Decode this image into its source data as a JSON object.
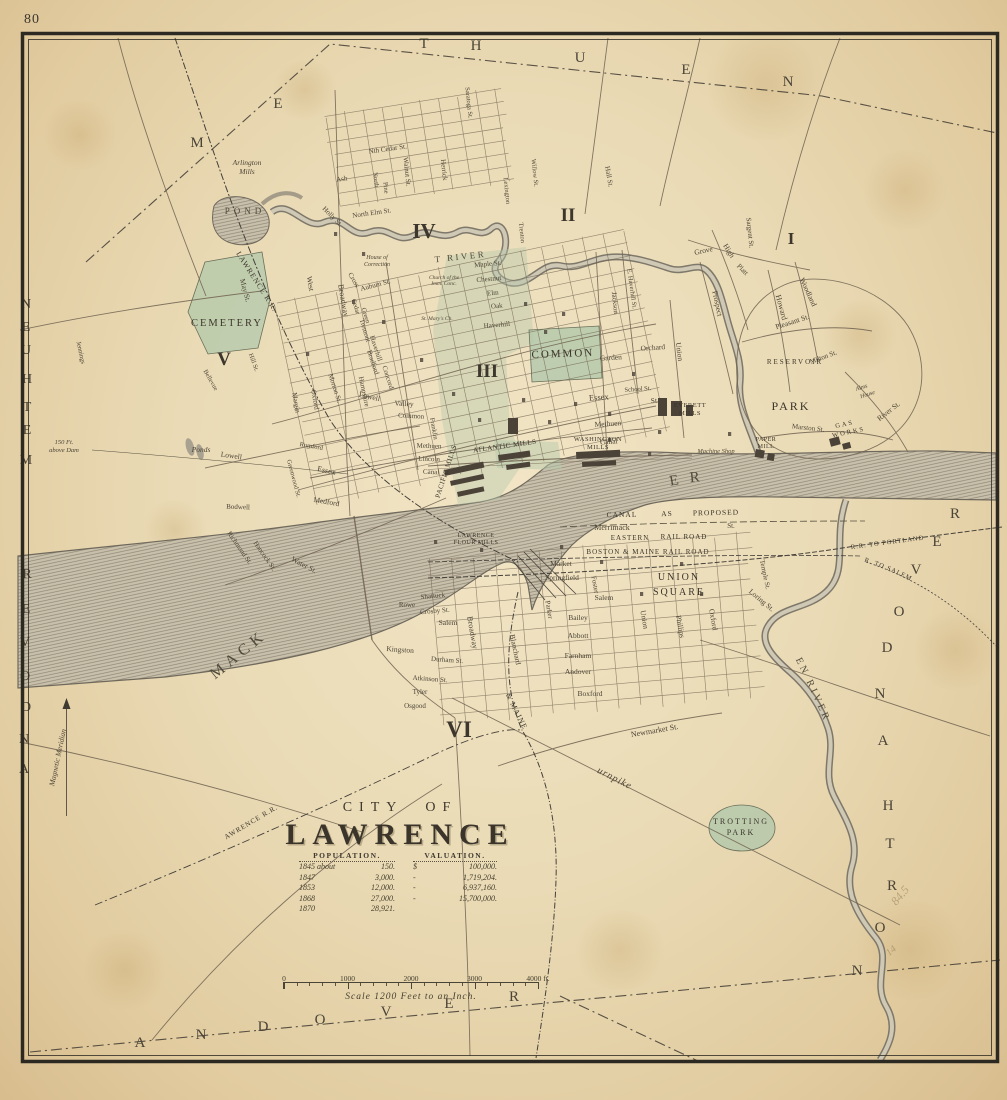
{
  "page_number": "80",
  "colors": {
    "paper": "#eadbb6",
    "ink": "#3e3830",
    "street": "#6f6250",
    "water_fill": "#c6bda8",
    "water_line": "#6f695c",
    "park_green": "#b4c8a9",
    "rail": "#45403a",
    "border": "#2c2822"
  },
  "title_block": {
    "line1": "CITY OF",
    "line2": "LAWRENCE"
  },
  "statistics": {
    "population_header": "POPULATION.",
    "valuation_header": "VALUATION.",
    "population_rows": [
      [
        "1845 about",
        "150."
      ],
      [
        "1847",
        "3,000."
      ],
      [
        "1853",
        "12,000."
      ],
      [
        "1868",
        "27,000."
      ],
      [
        "1870",
        "28,921."
      ]
    ],
    "valuation_rows": [
      [
        "$",
        "100,000."
      ],
      [
        "-",
        "1,719,204."
      ],
      [
        "-",
        "6,937,160."
      ],
      [
        "-",
        "15,700,000."
      ]
    ]
  },
  "scale_bar": {
    "tick_labels": [
      "0",
      "1000",
      "2000",
      "3000",
      "4000 ft."
    ],
    "caption": "Scale 1200 Feet to an Inch."
  },
  "boundaries": {
    "north": "METHUEN",
    "west_upper": "METHUEN",
    "west_lower": "ANDOVER",
    "south": "ANDOVER",
    "east": "NORTH ANDOVER"
  },
  "districts": [
    "I",
    "II",
    "III",
    "IV",
    "V",
    "VI"
  ],
  "waterways": [
    "MERRIMACK RIVER",
    "SPICKET RIVER",
    "SHAWSHEEN RIVER",
    "POND",
    "Ponds"
  ],
  "railroads": [
    "MANCHESTER & LAWRENCE R.R.",
    "LOWELL AND LAWRENCE R.R.",
    "EASTERN RAIL ROAD",
    "BOSTON & MAINE RAIL ROAD",
    "BOSTON & MAINE R.R. TO PORTLAND",
    "EASTERN R.R. TO SALEM",
    "BOSTON & MAINE",
    "CANAL AS PROPOSED"
  ],
  "compass_label": "Magnetic Meridian",
  "elevation_note": "150 Ft. above Dam",
  "curved_labels": [
    {
      "t": "MERRIMACK",
      "path": "cpMerrimack",
      "s": 16,
      "ls": 5,
      "c": "w"
    },
    {
      "t": "RIVER",
      "path": "cpRiver",
      "s": 15,
      "ls": 11,
      "c": "w"
    },
    {
      "t": "SPICKET RIVER",
      "path": "cpSpicket",
      "s": 9,
      "ls": 2.5,
      "c": "w"
    },
    {
      "t": "SHAWSHEEN RIVER",
      "path": "cpShawsheen",
      "s": 10,
      "ls": 3,
      "c": "w"
    },
    {
      "t": "MANCHESTER & LAWRENCE R.R.",
      "path": "cpML",
      "s": 7.5,
      "ls": 1,
      "c": "rr"
    },
    {
      "t": "LOWELL AND LAWRENCE R.R.",
      "path": "cpLL",
      "s": 7,
      "ls": 0.5,
      "c": "rr"
    },
    {
      "t": "BOSTON & MAINE R.R. TO PORTLAND",
      "path": "cpPortland",
      "s": 6.5,
      "ls": 0.3,
      "c": "rr"
    },
    {
      "t": "EASTERN R.R. TO SALEM",
      "path": "cpSalem",
      "s": 6.5,
      "ls": 0.5,
      "c": "rr"
    },
    {
      "t": "BOSTON & MAINE",
      "path": "cpBMsouth",
      "s": 7.5,
      "ls": 1.5,
      "c": "rr"
    },
    {
      "t": "Salem Turnpike",
      "path": "cpTurnpike",
      "s": 10,
      "ls": 1,
      "c": "n"
    }
  ],
  "labels": [
    [
      "M",
      197,
      147,
      0,
      15,
      "e"
    ],
    [
      "E",
      278,
      108,
      0,
      15,
      "e"
    ],
    [
      "T",
      424,
      48,
      0,
      15,
      "e"
    ],
    [
      "H",
      476,
      50,
      0,
      15,
      "e"
    ],
    [
      "U",
      580,
      62,
      0,
      15,
      "e"
    ],
    [
      "E",
      686,
      74,
      0,
      15,
      "e"
    ],
    [
      "N",
      788,
      86,
      0,
      15,
      "e"
    ],
    [
      "N",
      26,
      308,
      0,
      14,
      "e"
    ],
    [
      "E",
      26,
      331,
      0,
      14,
      "e"
    ],
    [
      "U",
      26,
      354,
      0,
      14,
      "e"
    ],
    [
      "H",
      27,
      383,
      0,
      14,
      "e"
    ],
    [
      "T",
      27,
      411,
      0,
      14,
      "e"
    ],
    [
      "E",
      27,
      434,
      0,
      14,
      "e"
    ],
    [
      "M",
      26,
      464,
      0,
      14,
      "e"
    ],
    [
      "R",
      27,
      578,
      0,
      14,
      "e"
    ],
    [
      "E",
      26,
      613,
      0,
      14,
      "e"
    ],
    [
      "V",
      25,
      646,
      0,
      14,
      "e"
    ],
    [
      "O",
      25,
      680,
      0,
      14,
      "e"
    ],
    [
      "D",
      26,
      711,
      0,
      14,
      "e"
    ],
    [
      "N",
      24,
      743,
      0,
      14,
      "e"
    ],
    [
      "A",
      24,
      773,
      0,
      14,
      "e"
    ],
    [
      "A",
      140,
      1047,
      0,
      15,
      "e"
    ],
    [
      "N",
      201,
      1039,
      0,
      15,
      "e"
    ],
    [
      "D",
      263,
      1031,
      0,
      15,
      "e"
    ],
    [
      "O",
      320,
      1024,
      0,
      15,
      "e"
    ],
    [
      "V",
      386,
      1016,
      0,
      15,
      "e"
    ],
    [
      "E",
      449,
      1008,
      0,
      15,
      "e"
    ],
    [
      "R",
      514,
      1001,
      0,
      15,
      "e"
    ],
    [
      "R",
      955,
      518,
      0,
      15,
      "e"
    ],
    [
      "E",
      937,
      546,
      0,
      15,
      "e"
    ],
    [
      "V",
      916,
      574,
      0,
      15,
      "e"
    ],
    [
      "O",
      899,
      616,
      0,
      15,
      "e"
    ],
    [
      "D",
      887,
      652,
      0,
      15,
      "e"
    ],
    [
      "N",
      880,
      698,
      0,
      15,
      "e"
    ],
    [
      "A",
      883,
      745,
      0,
      15,
      "e"
    ],
    [
      "H",
      888,
      810,
      0,
      15,
      "e"
    ],
    [
      "T",
      890,
      848,
      0,
      15,
      "e"
    ],
    [
      "R",
      892,
      890,
      0,
      15,
      "e"
    ],
    [
      "O",
      880,
      932,
      0,
      15,
      "e"
    ],
    [
      "N",
      857,
      975,
      0,
      15,
      "e"
    ],
    [
      "I",
      791,
      244,
      0,
      17,
      "d"
    ],
    [
      "II",
      568,
      221,
      0,
      19,
      "d"
    ],
    [
      "III",
      487,
      377,
      0,
      19,
      "d"
    ],
    [
      "IV",
      424,
      238,
      0,
      21,
      "d"
    ],
    [
      "V",
      224,
      365,
      0,
      19,
      "d"
    ],
    [
      "VI",
      459,
      737,
      0,
      23,
      "d"
    ],
    [
      "POND",
      245,
      214,
      0,
      9,
      "w",
      4
    ],
    [
      "Ponds",
      201,
      452,
      0,
      7.5,
      "n"
    ],
    [
      "CEMETERY",
      227,
      326,
      0,
      10.5,
      "p"
    ],
    [
      "COMMON",
      563,
      357,
      -2,
      11,
      "p"
    ],
    [
      "PARK",
      791,
      410,
      0,
      12,
      "p"
    ],
    [
      "UNION",
      679,
      580,
      0,
      10,
      "p"
    ],
    [
      "SQUARE",
      679,
      595,
      0,
      10,
      "p"
    ],
    [
      "TROTTING",
      741,
      824,
      0,
      8,
      "p"
    ],
    [
      "PARK",
      741,
      835,
      0,
      8,
      "p"
    ],
    [
      "RESERVOIR",
      795,
      364,
      0,
      7,
      "p"
    ],
    [
      "GAS",
      845,
      426,
      -12,
      6.5,
      "p"
    ],
    [
      "WORKS",
      849,
      434,
      -12,
      6.5,
      "p"
    ],
    [
      "EVERETT",
      690,
      407,
      0,
      6.5,
      "m"
    ],
    [
      "MILLS",
      690,
      415,
      0,
      6.5,
      "m"
    ],
    [
      "WASHINGTON",
      598,
      441,
      0,
      6.5,
      "m"
    ],
    [
      "MILLS",
      598,
      449,
      0,
      6.5,
      "m"
    ],
    [
      "PACIFIC MILLS",
      448,
      472,
      -72,
      7,
      "m"
    ],
    [
      "ATLANTIC MILLS",
      505,
      448,
      -8,
      7,
      "m"
    ],
    [
      "LAWRENCE",
      476,
      537,
      0,
      6,
      "m"
    ],
    [
      "FLOUR MILLS",
      476,
      544,
      0,
      6,
      "m"
    ],
    [
      "PAPER",
      766,
      441,
      0,
      6,
      "m"
    ],
    [
      "MILL",
      766,
      448,
      0,
      6,
      "m"
    ],
    [
      "Machine Shop",
      716,
      453,
      0,
      6.5,
      "n"
    ],
    [
      "Arlington",
      247,
      165,
      0,
      7.5,
      "n"
    ],
    [
      "Mills",
      247,
      174,
      0,
      7.5,
      "n"
    ],
    [
      "House of",
      377,
      259,
      0,
      6,
      "n"
    ],
    [
      "Correction",
      377,
      266,
      0,
      6,
      "n"
    ],
    [
      "Church of the",
      444,
      279,
      0,
      5.5,
      "n"
    ],
    [
      "Imm. Conc.",
      444,
      285,
      0,
      5.5,
      "n"
    ],
    [
      "St. Mary's Ch.",
      437,
      320,
      0,
      5.5,
      "n"
    ],
    [
      "Alms",
      862,
      389,
      -18,
      6,
      "n"
    ],
    [
      "House",
      868,
      396,
      -18,
      6,
      "n"
    ],
    [
      "150 Ft.",
      64,
      444,
      0,
      6.5,
      "n"
    ],
    [
      "above Dam",
      64,
      452,
      0,
      6.5,
      "n"
    ],
    [
      "Magnetic Meridian",
      60,
      758,
      -78,
      7.5,
      "n"
    ],
    [
      "Merrimack",
      612,
      530,
      0,
      8,
      "s"
    ],
    [
      "St.",
      731,
      528,
      0,
      7,
      "s"
    ],
    [
      "EASTERN",
      630,
      540,
      0,
      7,
      "rr"
    ],
    [
      "RAIL ROAD",
      684,
      539,
      0,
      7,
      "rr"
    ],
    [
      "BOSTON & MAINE RAIL ROAD",
      648,
      554,
      0,
      7,
      "rr"
    ],
    [
      "CANAL",
      622,
      517,
      -1,
      7.5,
      "rr"
    ],
    [
      "AS",
      667,
      516,
      -1,
      7.5,
      "rr"
    ],
    [
      "PROPOSED",
      716,
      515,
      -1,
      7.5,
      "rr"
    ],
    [
      "Nth Cedar St.",
      388,
      151,
      -8,
      7,
      "s"
    ],
    [
      "Ash",
      342,
      181,
      -8,
      7,
      "s"
    ],
    [
      "Walnut St.",
      405,
      172,
      84,
      7,
      "s"
    ],
    [
      "Herrick",
      442,
      170,
      84,
      7,
      "s"
    ],
    [
      "North",
      374,
      180,
      84,
      6.5,
      "s"
    ],
    [
      "Pine",
      384,
      188,
      84,
      6.5,
      "s"
    ],
    [
      "North Elm St.",
      372,
      215,
      -8,
      7,
      "s"
    ],
    [
      "Holly St.",
      331,
      218,
      45,
      7,
      "s"
    ],
    [
      "West",
      308,
      284,
      80,
      7.5,
      "s"
    ],
    [
      "May St.",
      243,
      291,
      75,
      7.5,
      "s"
    ],
    [
      "Cross",
      352,
      281,
      60,
      7,
      "s"
    ],
    [
      "Auburn St.",
      376,
      287,
      -15,
      7,
      "s"
    ],
    [
      "Broadway",
      341,
      301,
      80,
      8,
      "s"
    ],
    [
      "Hampshire",
      362,
      392,
      78,
      7,
      "s"
    ],
    [
      "Oxford",
      313,
      400,
      80,
      7,
      "s"
    ],
    [
      "Margin",
      294,
      403,
      80,
      7,
      "s"
    ],
    [
      "Morton St.",
      333,
      389,
      72,
      7,
      "s"
    ],
    [
      "Tremont",
      363,
      331,
      73,
      7,
      "s"
    ],
    [
      "Cedar",
      354,
      307,
      73,
      6.5,
      "s"
    ],
    [
      "Green",
      364,
      316,
      73,
      6.5,
      "s"
    ],
    [
      "Haverhill",
      374,
      349,
      72,
      7,
      "s"
    ],
    [
      "Bradford",
      371,
      363,
      72,
      7,
      "s"
    ],
    [
      "Concord",
      386,
      378,
      72,
      7,
      "s"
    ],
    [
      "Lowell",
      369,
      399,
      12,
      7.5,
      "s"
    ],
    [
      "Valley",
      404,
      406,
      3,
      7.5,
      "s"
    ],
    [
      "Common",
      411,
      418,
      3,
      7,
      "s"
    ],
    [
      "Franklin",
      432,
      429,
      80,
      6.5,
      "s"
    ],
    [
      "Methuen",
      429,
      448,
      2,
      7,
      "s"
    ],
    [
      "Lincoln",
      429,
      461,
      2,
      7,
      "s"
    ],
    [
      "Canal",
      431,
      474,
      2,
      7,
      "s"
    ],
    [
      "Essex",
      326,
      473,
      12,
      8,
      "s"
    ],
    [
      "Lowell",
      231,
      458,
      8,
      7.5,
      "s"
    ],
    [
      "Medford",
      326,
      504,
      10,
      7.5,
      "s"
    ],
    [
      "Water St.",
      303,
      567,
      28,
      7.5,
      "s"
    ],
    [
      "Hancock St.",
      263,
      557,
      55,
      7,
      "s"
    ],
    [
      "Richmond St.",
      238,
      549,
      55,
      7,
      "s"
    ],
    [
      "Bodwell",
      238,
      509,
      2,
      7,
      "s"
    ],
    [
      "Greenwood St.",
      292,
      479,
      75,
      6.5,
      "s"
    ],
    [
      "Rumford",
      311,
      448,
      10,
      6.5,
      "s"
    ],
    [
      "Bellevue",
      209,
      381,
      60,
      6.5,
      "s"
    ],
    [
      "Hill St.",
      252,
      363,
      70,
      6.5,
      "s"
    ],
    [
      "Jennings",
      79,
      353,
      78,
      6.5,
      "s"
    ],
    [
      "Maple St.",
      488,
      266,
      -5,
      7,
      "s"
    ],
    [
      "Chestnut",
      489,
      281,
      -5,
      7,
      "s"
    ],
    [
      "Elm",
      493,
      295,
      -5,
      7,
      "s"
    ],
    [
      "Oak",
      497,
      308,
      -5,
      7,
      "s"
    ],
    [
      "Haverhill",
      497,
      327,
      -5,
      7,
      "s"
    ],
    [
      "Garden",
      611,
      360,
      -4,
      7.5,
      "s"
    ],
    [
      "Essex",
      599,
      400,
      -4,
      8.5,
      "s"
    ],
    [
      "St.",
      655,
      403,
      -4,
      7.5,
      "s"
    ],
    [
      "Methuen",
      608,
      426,
      -4,
      7.5,
      "s"
    ],
    [
      "Canal",
      609,
      444,
      -4,
      7.5,
      "s"
    ],
    [
      "Orchard",
      653,
      350,
      -4,
      7.5,
      "s"
    ],
    [
      "Union",
      677,
      352,
      82,
      7.5,
      "s"
    ],
    [
      "Jackson",
      613,
      303,
      84,
      7,
      "s"
    ],
    [
      "E. Haverhill St.",
      630,
      289,
      82,
      6.5,
      "s"
    ],
    [
      "School St.",
      638,
      391,
      -4,
      6.5,
      "s"
    ],
    [
      "Lexington",
      505,
      191,
      84,
      6.5,
      "s"
    ],
    [
      "Trenton",
      520,
      233,
      84,
      6.5,
      "s"
    ],
    [
      "Willow St.",
      533,
      173,
      84,
      6.5,
      "s"
    ],
    [
      "Saratoga St.",
      467,
      103,
      84,
      6.5,
      "s"
    ],
    [
      "Hall St.",
      607,
      177,
      80,
      7,
      "s"
    ],
    [
      "Prospect",
      715,
      304,
      78,
      7.5,
      "s"
    ],
    [
      "High",
      727,
      252,
      58,
      7.5,
      "s"
    ],
    [
      "Grove",
      704,
      253,
      -12,
      7.5,
      "s"
    ],
    [
      "Sargent St.",
      748,
      233,
      84,
      7,
      "s"
    ],
    [
      "Platt",
      741,
      271,
      45,
      7,
      "s"
    ],
    [
      "Howard",
      779,
      308,
      75,
      8,
      "s"
    ],
    [
      "Woodland",
      806,
      293,
      65,
      7.5,
      "s"
    ],
    [
      "Pleasant St.",
      793,
      324,
      -18,
      7.5,
      "s"
    ],
    [
      "Milton St.",
      824,
      359,
      -20,
      7,
      "s"
    ],
    [
      "Marston St.",
      808,
      430,
      6,
      7,
      "s"
    ],
    [
      "River St.",
      890,
      413,
      -38,
      7.5,
      "s"
    ],
    [
      "Market",
      561,
      566,
      0,
      7.5,
      "s"
    ],
    [
      "Springfield",
      562,
      580,
      0,
      7.5,
      "s"
    ],
    [
      "Salem",
      604,
      600,
      0,
      7.5,
      "s"
    ],
    [
      "Salem",
      448,
      625,
      0,
      7.5,
      "s"
    ],
    [
      "Bailey",
      578,
      620,
      0,
      7.5,
      "s"
    ],
    [
      "Abbott",
      578,
      638,
      0,
      7.5,
      "s"
    ],
    [
      "Farnham",
      578,
      658,
      0,
      7.5,
      "s"
    ],
    [
      "Andover",
      578,
      674,
      0,
      7.5,
      "s"
    ],
    [
      "Boxford",
      590,
      696,
      0,
      7.5,
      "s"
    ],
    [
      "Kingston",
      400,
      652,
      4,
      7.5,
      "s"
    ],
    [
      "Durham St.",
      447,
      662,
      4,
      7,
      "s"
    ],
    [
      "Atkinson St.",
      430,
      681,
      4,
      7,
      "s"
    ],
    [
      "Tyler",
      420,
      694,
      0,
      7,
      "s"
    ],
    [
      "Osgood",
      415,
      708,
      0,
      7,
      "s"
    ],
    [
      "Shattuck",
      433,
      598,
      -5,
      7,
      "s"
    ],
    [
      "Rowe",
      407,
      607,
      0,
      7,
      "s"
    ],
    [
      "Crosby St.",
      435,
      613,
      -5,
      7,
      "s"
    ],
    [
      "Broadway",
      470,
      633,
      80,
      8,
      "s"
    ],
    [
      "Blanchard",
      513,
      650,
      78,
      7.5,
      "s"
    ],
    [
      "Parker",
      547,
      610,
      80,
      7,
      "s"
    ],
    [
      "Foster",
      593,
      585,
      80,
      7,
      "s"
    ],
    [
      "Oxford",
      711,
      620,
      80,
      7.5,
      "s"
    ],
    [
      "Phillips",
      678,
      627,
      80,
      7.5,
      "s"
    ],
    [
      "Union",
      642,
      620,
      80,
      7.5,
      "s"
    ],
    [
      "Temple St.",
      763,
      575,
      78,
      7,
      "s"
    ],
    [
      "Loring St.",
      760,
      602,
      40,
      7.5,
      "s"
    ],
    [
      "Newmarket St.",
      655,
      733,
      -10,
      8,
      "s"
    ],
    [
      "84.5",
      903,
      898,
      -50,
      12,
      "pencil"
    ],
    [
      "14",
      893,
      953,
      -40,
      10,
      "pencil"
    ]
  ]
}
